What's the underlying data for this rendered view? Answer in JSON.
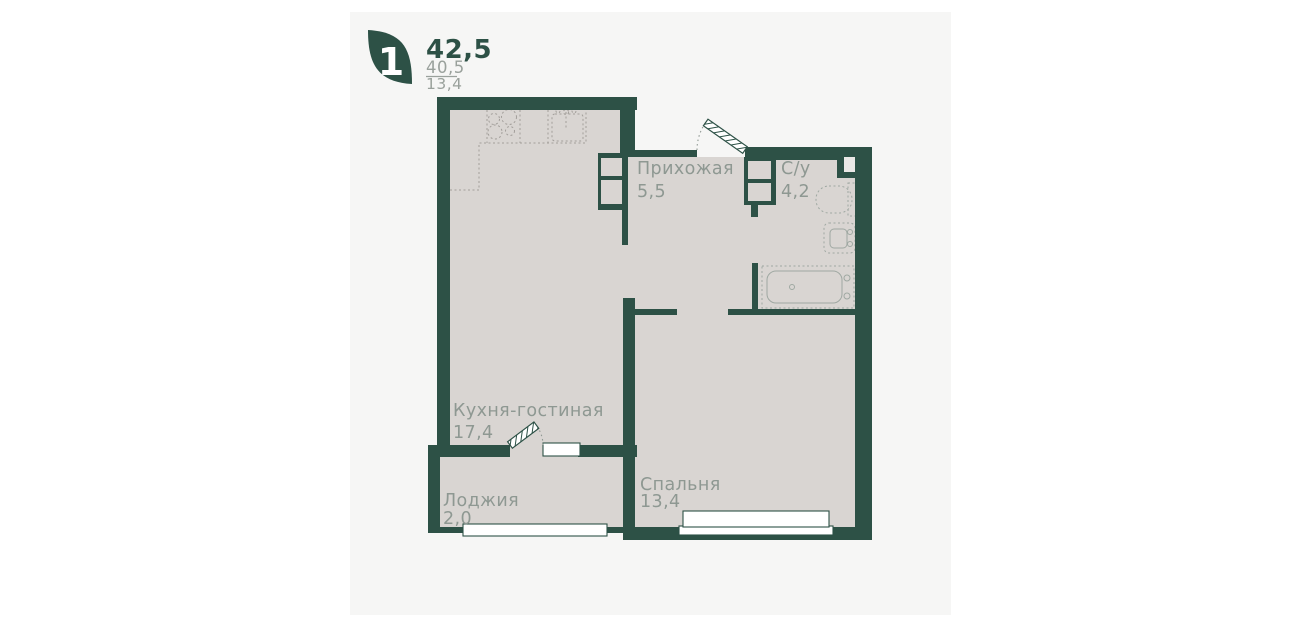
{
  "card": {
    "legend": {
      "rooms_badge": "1",
      "area_total": "42,5",
      "area_living": "40,5",
      "area_kitchen": "13,4"
    },
    "rooms": {
      "hallway": {
        "name": "Прихожая",
        "area": "5,5"
      },
      "bathroom": {
        "name": "С/у",
        "area": "4,2"
      },
      "kitchen_living": {
        "name": "Кухня-гостиная",
        "area": "17,4"
      },
      "loggia": {
        "name": "Лоджия",
        "area": "2,0"
      },
      "bedroom": {
        "name": "Спальня",
        "area": "13,4"
      }
    },
    "colors": {
      "wall": "#2d5146",
      "floor": "#d9d5d2",
      "card_background": "#f6f6f5",
      "page_background": "#ffffff",
      "label_text": "#8e9892",
      "secondary_text": "#9aa19c"
    }
  }
}
